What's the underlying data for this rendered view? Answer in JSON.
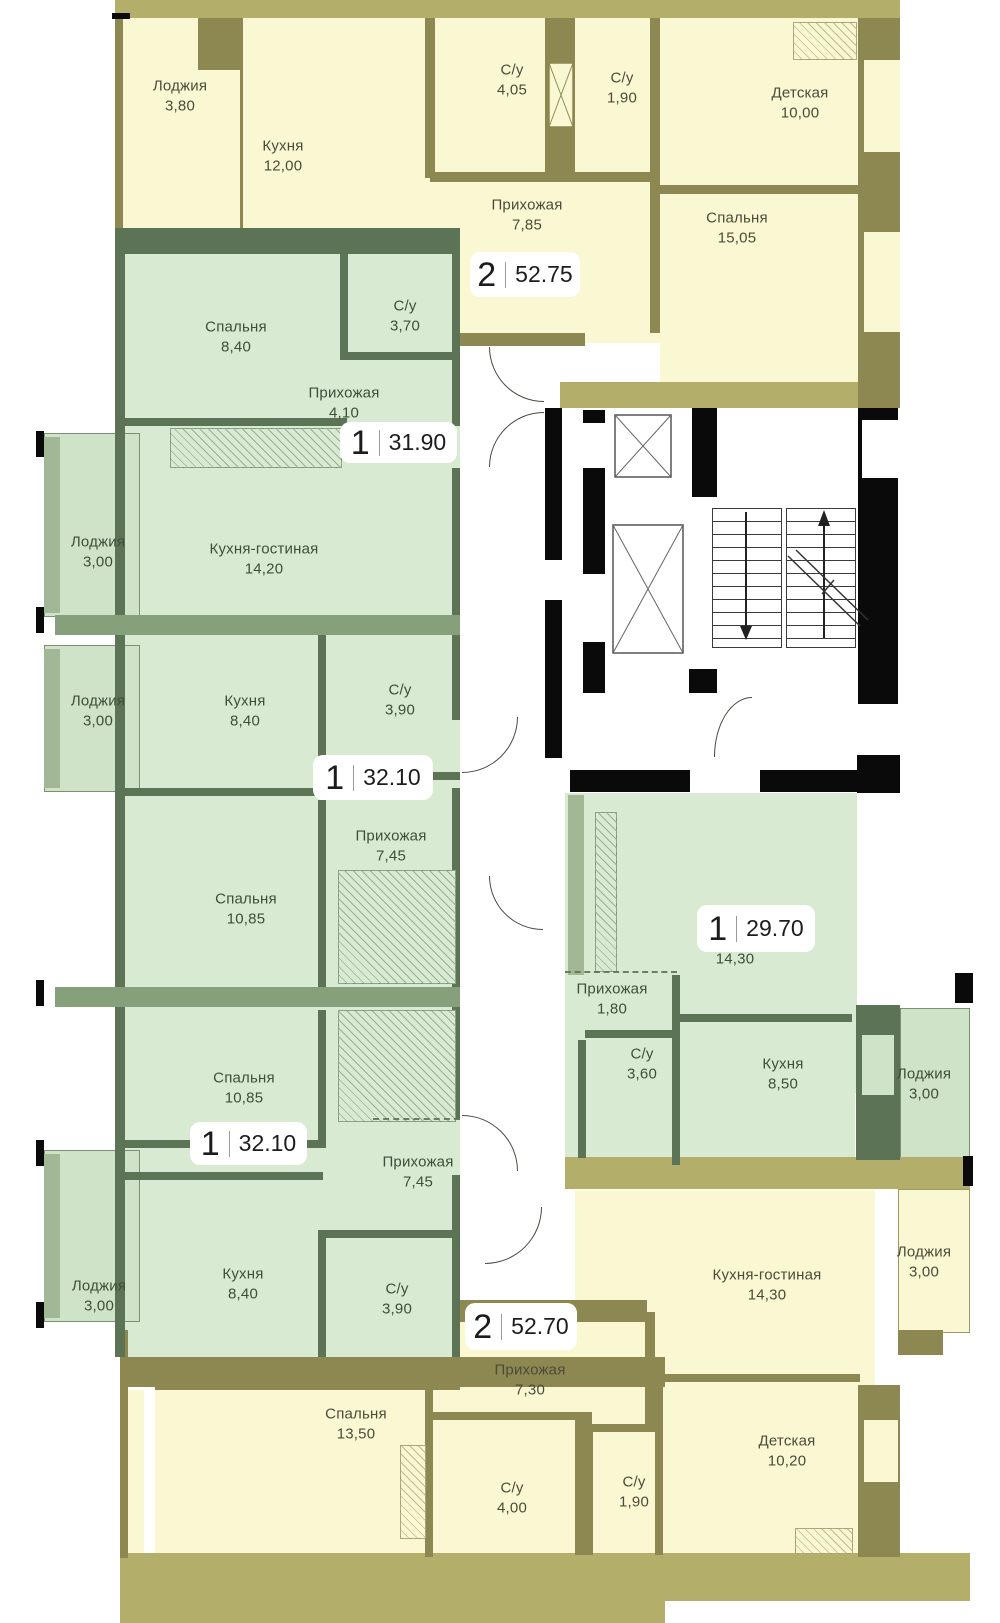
{
  "colors": {
    "yellow_fill": "#faf8d2",
    "yellow_wall": "#8d8851",
    "yellow_band": "#b3ae6a",
    "green_fill": "#d8ead2",
    "green_loggia_fill": "#cfe3c8",
    "green_wall": "#5d7355",
    "green_band": "#85a07a",
    "green_light": "#a1b795",
    "core_wall": "#0a0a0a",
    "badge_bg": "#ffffff",
    "badge_text": "#1c1c1c",
    "label_yellow": "#4b4b3b",
    "label_green": "#3e4e3a"
  },
  "plan": {
    "apartments": [
      {
        "badge": {
          "rooms": "2",
          "area": "52.75"
        },
        "rooms": [
          {
            "name": "Лоджия",
            "area": "3,80"
          },
          {
            "name": "Кухня",
            "area": "12,00"
          },
          {
            "name": "С/у",
            "area": "4,05"
          },
          {
            "name": "С/у",
            "area": "1,90"
          },
          {
            "name": "Детская",
            "area": "10,00"
          },
          {
            "name": "Прихожая",
            "area": "7,85"
          },
          {
            "name": "Спальня",
            "area": "15,05"
          }
        ]
      },
      {
        "badge": {
          "rooms": "1",
          "area": "31.90"
        },
        "rooms": [
          {
            "name": "Спальня",
            "area": "8,40"
          },
          {
            "name": "С/у",
            "area": "3,70"
          },
          {
            "name": "Прихожая",
            "area": "4,10"
          },
          {
            "name": "Лоджия",
            "area": "3,00"
          },
          {
            "name": "Кухня-гостиная",
            "area": "14,20"
          }
        ]
      },
      {
        "badge": {
          "rooms": "1",
          "area": "32.10"
        },
        "rooms": [
          {
            "name": "Лоджия",
            "area": "3,00"
          },
          {
            "name": "Кухня",
            "area": "8,40"
          },
          {
            "name": "С/у",
            "area": "3,90"
          },
          {
            "name": "Прихожая",
            "area": "7,45"
          },
          {
            "name": "Спальня",
            "area": "10,85"
          }
        ]
      },
      {
        "badge": {
          "rooms": "1",
          "area": "32.10"
        },
        "rooms": [
          {
            "name": "Спальня",
            "area": "10,85"
          },
          {
            "name": "Прихожая",
            "area": "7,45"
          },
          {
            "name": "Лоджия",
            "area": "3,00"
          },
          {
            "name": "Кухня",
            "area": "8,40"
          },
          {
            "name": "С/у",
            "area": "3,90"
          }
        ]
      },
      {
        "badge": {
          "rooms": "1",
          "area": "29.70"
        },
        "rooms": [
          {
            "name": "",
            "area": "14,30"
          },
          {
            "name": "Прихожая",
            "area": "1,80"
          },
          {
            "name": "С/у",
            "area": "3,60"
          },
          {
            "name": "Кухня",
            "area": "8,50"
          },
          {
            "name": "Лоджия",
            "area": "3,00"
          }
        ]
      },
      {
        "badge": {
          "rooms": "2",
          "area": "52.70"
        },
        "rooms": [
          {
            "name": "Кухня-гостиная",
            "area": "14,30"
          },
          {
            "name": "Лоджия",
            "area": "3,00"
          },
          {
            "name": "Прихожая",
            "area": "7,30"
          },
          {
            "name": "Спальня",
            "area": "13,50"
          },
          {
            "name": "С/у",
            "area": "4,00"
          },
          {
            "name": "С/у",
            "area": "1,90"
          },
          {
            "name": "Детская",
            "area": "10,20"
          }
        ]
      }
    ]
  }
}
